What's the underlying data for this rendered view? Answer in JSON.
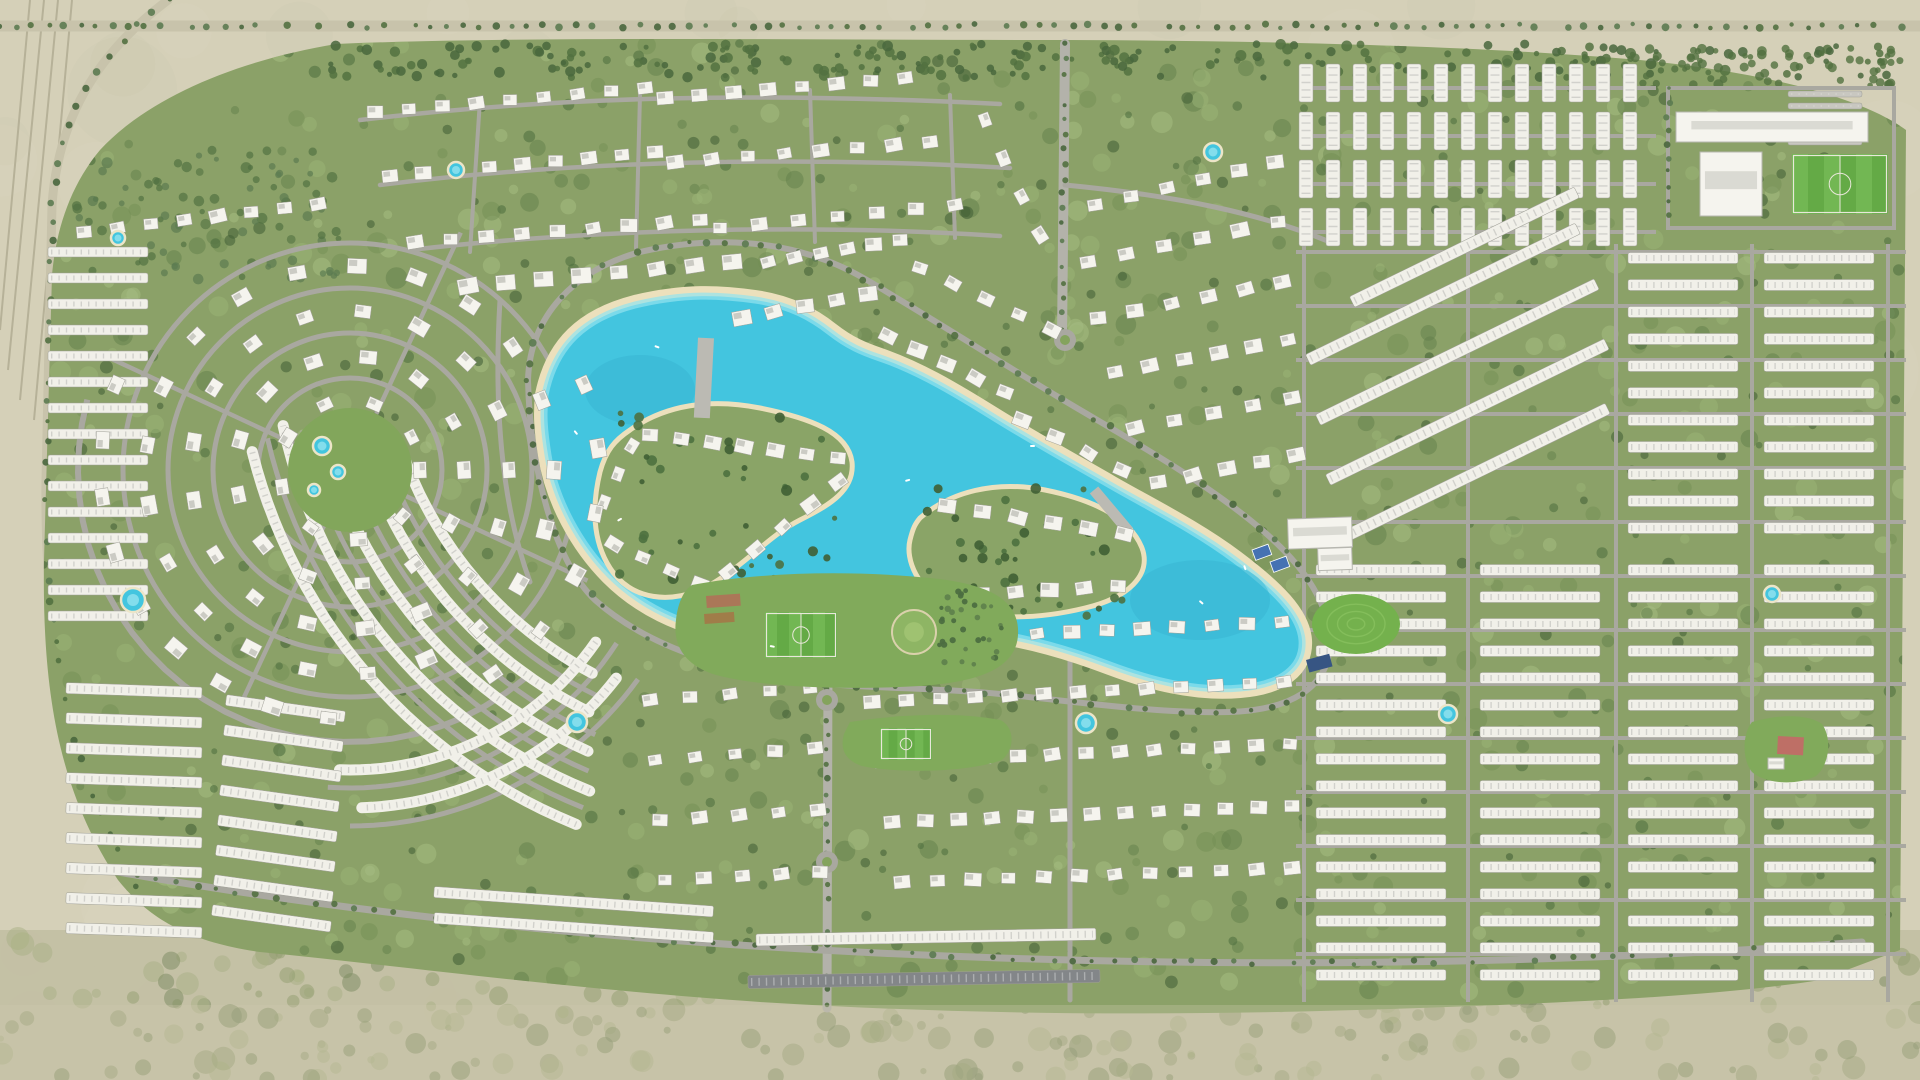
{
  "meta": {
    "type": "community-master-plan-aerial-render",
    "colors": {
      "desert": "#d4cfb6",
      "scrub": "#c0bda0",
      "green_base": "#879e62",
      "road": "#a6a59d",
      "boulevard": "#b0afa7",
      "building_white": "#f5f4ee",
      "building_dark_roof": "#7e8285",
      "water": "#3cc3de",
      "water_shallow": "#8fe2ef",
      "beach_sand": "#ecdfba",
      "pitch_green": "#5ea73f",
      "court_blue": "#3e6db0",
      "park_green": "#7ca755",
      "tree_dark": "#4a6a39"
    }
  },
  "desert": {
    "rails": [
      "M30,0 L0,330",
      "M44,0 L8,370",
      "M58,0 L20,400",
      "M72,0 L34,420"
    ],
    "left_highway": "M168,0 C95,55 58,120 52,205 L46,480 C44,640 70,780 140,890",
    "top_highway": "M0,26 L1920,26",
    "west_spur": "M46,478 L150,474"
  },
  "green_path": "M336,44 C240,60 150,96 100,150 C70,186 56,230 52,275 L44,560 C42,690 58,790 118,880 C150,920 190,942 260,952 C420,968 560,988 760,1002 C980,1016 1200,1016 1420,1008 C1580,1002 1720,996 1820,980 L1900,950 L1906,130 C1860,96 1760,72 1640,60 C1480,46 1260,40 1040,40 C800,40 520,36 336,44 Z",
  "roads": {
    "paths": [
      {
        "d": "M360,120 C560,96 760,92 1000,104",
        "w": 4.5
      },
      {
        "d": "M380,185 C580,160 800,156 1010,168",
        "w": 4.5
      },
      {
        "d": "M410,250 C600,228 820,224 1000,236",
        "w": 4.5
      },
      {
        "d": "M480,100 L470,252",
        "w": 4
      },
      {
        "d": "M640,95 L636,248",
        "w": 4
      },
      {
        "d": "M810,90 L815,242",
        "w": 4
      },
      {
        "d": "M950,95 L955,238",
        "w": 4
      },
      {
        "d": "M1065,44 L1062,340",
        "w": 10,
        "c": "#b0afa7"
      },
      {
        "d": "M1065,185 C1180,196 1262,214 1330,242",
        "w": 5
      },
      {
        "d": "M500,300 C494,400 500,500 530,582",
        "w": 5
      },
      {
        "d": "M828,660 L827,1008",
        "w": 9,
        "c": "#b0afa7"
      },
      {
        "d": "M528,380 C530,315 575,270 640,252 C700,238 755,240 800,252 C845,264 870,282 900,300 C950,330 1000,362 1060,398 C1120,434 1190,472 1250,520 C1300,560 1330,600 1330,645 C1328,688 1290,710 1230,712 C1160,714 1080,702 1000,694 C920,686 840,690 770,676 C700,662 640,640 595,600 C555,562 530,470 528,380 Z",
        "w": 6
      },
      {
        "d": "M118,872 C400,922 700,948 1000,958 C1300,968 1600,962 1862,942",
        "w": 7
      },
      {
        "d": "M1070,620 L1070,1000",
        "w": 5
      },
      {
        "d": "M1668,88 L1894,88 L1894,228 L1668,228 Z",
        "w": 4
      }
    ],
    "hlines": [
      {
        "x1": 1296,
        "x2": 1906,
        "ys": [
          252,
          306,
          360,
          414,
          468,
          522,
          576,
          630,
          684,
          738,
          792,
          846,
          900,
          954
        ],
        "w": 4
      },
      {
        "x1": 1300,
        "x2": 1656,
        "ys": [
          88,
          136,
          184,
          232
        ],
        "w": 4
      }
    ],
    "vlines": [
      {
        "y1": 244,
        "y2": 1002,
        "xs": [
          1304,
          1468,
          1616,
          1752,
          1888
        ],
        "w": 4
      }
    ],
    "rings": [
      [
        350,
        470,
        92,
        5
      ],
      [
        350,
        470,
        137,
        5
      ],
      [
        350,
        470,
        182,
        5
      ],
      [
        350,
        470,
        227,
        5
      ]
    ],
    "arcs": [
      [
        780,
        320,
        418,
        116,
        164,
        5
      ],
      [
        780,
        320,
        454,
        114,
        166,
        5
      ],
      [
        780,
        320,
        490,
        113,
        167,
        5
      ],
      [
        780,
        320,
        526,
        112,
        167,
        5
      ],
      [
        350,
        470,
        318,
        33,
        94,
        5
      ],
      [
        350,
        470,
        356,
        36,
        90,
        5
      ],
      [
        350,
        470,
        272,
        50,
        195,
        6
      ]
    ],
    "spokes": {
      "cx": 350,
      "cy": 470,
      "r0": 62,
      "r1": 262,
      "angles": [
        25,
        115,
        205,
        295
      ],
      "w": 4.5
    },
    "roundabouts": [
      [
        1065,
        340
      ],
      [
        827,
        700
      ],
      [
        827,
        862
      ]
    ]
  },
  "treelines": [
    {
      "d": "M0,26 L1920,26",
      "step": 16,
      "r": 3
    },
    {
      "d": "M1065,44 L1062,340",
      "step": 15,
      "r": 2.8
    },
    {
      "d": "M828,660 L827,1008",
      "step": 15,
      "r": 2.8
    },
    {
      "d": "M528,380 C530,315 575,270 640,252 C700,238 755,240 800,252 C845,264 870,282 900,300 C950,330 1000,362 1060,398 C1120,434 1190,472 1250,520 C1300,560 1330,600 1330,645 C1328,688 1290,710 1230,712 C1160,714 1080,702 1000,694 C920,686 840,690 770,676 C700,662 640,640 595,600 C555,562 530,470 528,380 Z",
      "step": 18,
      "r": 3
    },
    {
      "d": "M168,0 C95,55 58,120 52,205 L46,480 C44,640 70,780 140,890",
      "step": 20,
      "r": 3
    },
    {
      "d": "M118,872 C400,922 700,948 1000,958 C1300,968 1600,962 1862,942",
      "step": 20,
      "r": 2.8
    },
    {
      "d": "M1668,88 L1668,228",
      "step": 14,
      "r": 2.6
    }
  ],
  "scatters": [
    {
      "name": "desert-shading",
      "x": 0,
      "y": 0,
      "w": 1920,
      "h": 1080,
      "n": 130,
      "r0": 18,
      "r1": 55,
      "colors": [
        "#dcd7c0",
        "#c9c4a9"
      ],
      "op": 0.22,
      "seed": 11
    },
    {
      "name": "scrub-band",
      "x": 0,
      "y": 935,
      "w": 1920,
      "h": 145,
      "n": 320,
      "r0": 3,
      "r1": 12,
      "colors": [
        "#8e9a6a",
        "#76855a",
        "#a5ad7f"
      ],
      "op": 0.5,
      "seed": 7
    },
    {
      "name": "green-mottle",
      "x": 42,
      "y": 42,
      "w": 1862,
      "h": 950,
      "n": 760,
      "r0": 4,
      "r1": 11,
      "colors": [
        "#6e8a4d",
        "#97b171",
        "#5c7944",
        "#a3bb7e"
      ],
      "op": 0.5,
      "seed": 3,
      "clip": 1
    },
    {
      "name": "tree-clumps",
      "x": 42,
      "y": 42,
      "w": 1862,
      "h": 950,
      "n": 400,
      "r0": 3,
      "r1": 6.5,
      "colors": [
        "#4a6a39",
        "#3e5c30"
      ],
      "op": 0.6,
      "seed": 9,
      "clip": 1
    },
    {
      "name": "top-tree-band",
      "x": 330,
      "y": 44,
      "w": 1560,
      "h": 34,
      "n": 230,
      "r0": 2.5,
      "r1": 5.5,
      "colors": [
        "#4c6c3a",
        "#426236"
      ],
      "op": 0.85,
      "seed": 5
    },
    {
      "name": "nw-tree-band",
      "x": 70,
      "y": 150,
      "w": 270,
      "h": 130,
      "n": 90,
      "r0": 2.5,
      "r1": 5.5,
      "colors": [
        "#4c6c3a",
        "#55764a"
      ],
      "op": 0.7,
      "seed": 6,
      "clip": 1
    },
    {
      "name": "school-tree-band",
      "x": 1600,
      "y": 48,
      "w": 300,
      "h": 38,
      "n": 70,
      "r0": 2.5,
      "r1": 5,
      "colors": [
        "#4c6c3a"
      ],
      "op": 0.8,
      "seed": 16
    }
  ],
  "lagoon": {
    "water_d": "M545,395 C555,345 585,318 635,305 C685,293 720,295 755,300 C790,305 812,318 830,332 C848,346 862,352 880,358 C915,370 950,390 990,415 C1030,440 1070,462 1110,485 C1150,508 1195,530 1235,560 C1275,590 1300,615 1302,640 C1304,668 1280,685 1240,688 C1195,692 1150,680 1110,665 C1070,650 1030,638 985,632 C940,626 895,625 850,628 C805,631 765,638 725,632 C680,625 640,605 610,575 C580,545 555,500 548,455 C544,430 543,415 545,395 Z",
    "deep_spots": [
      [
        640,
        390,
        55,
        35
      ],
      [
        1200,
        600,
        70,
        40
      ]
    ],
    "islands": [
      {
        "name": "island-west",
        "d": "M630,430 C665,405 710,398 760,408 C810,418 848,432 852,462 C855,490 830,505 800,520 C770,535 745,565 710,585 C672,606 630,600 610,568 C592,540 592,505 600,472 C606,450 615,440 630,430 Z"
      },
      {
        "name": "island-east",
        "d": "M920,518 C950,492 995,480 1045,490 C1095,500 1130,518 1142,548 C1152,575 1128,598 1085,608 C1040,619 985,622 948,604 C918,590 905,560 910,540 C913,528 915,524 920,518 Z"
      }
    ],
    "island_tree_scatters": [
      {
        "x": 612,
        "y": 412,
        "w": 232,
        "h": 185,
        "n": 46,
        "r0": 2.5,
        "r1": 5.5,
        "colors": [
          "#466c38",
          "#39592c"
        ],
        "op": 0.9,
        "seed": 13
      },
      {
        "x": 918,
        "y": 488,
        "w": 218,
        "h": 128,
        "n": 36,
        "r0": 2.5,
        "r1": 5.5,
        "colors": [
          "#466c38",
          "#39592c"
        ],
        "op": 0.9,
        "seed": 14
      }
    ],
    "bridges": [
      [
        706,
        338,
        16,
        80,
        3
      ],
      [
        1094,
        490,
        11,
        54,
        -40
      ],
      [
        698,
        580,
        10,
        56,
        1
      ]
    ],
    "boats": [
      [
        655,
        345,
        20
      ],
      [
        905,
        480,
        -15
      ],
      [
        1200,
        600,
        40
      ],
      [
        770,
        645,
        10
      ],
      [
        617,
        520,
        -30
      ],
      [
        1245,
        565,
        70
      ],
      [
        1030,
        445,
        0
      ],
      [
        575,
        430,
        50
      ]
    ]
  },
  "villa_rows": [
    [
      375,
      112,
      645,
      88,
      9,
      15
    ],
    [
      665,
      98,
      905,
      78,
      8,
      15
    ],
    [
      390,
      176,
      655,
      152,
      9,
      15
    ],
    [
      675,
      162,
      930,
      142,
      8,
      15
    ],
    [
      415,
      242,
      700,
      220,
      9,
      15
    ],
    [
      720,
      228,
      955,
      205,
      7,
      15
    ],
    [
      985,
      120,
      1040,
      235,
      4,
      15
    ],
    [
      468,
      286,
      732,
      262,
      8,
      19
    ],
    [
      742,
      318,
      868,
      294,
      5,
      17
    ],
    [
      888,
      336,
      1005,
      392,
      5,
      17
    ],
    [
      1022,
      420,
      1122,
      470,
      4,
      17
    ],
    [
      768,
      262,
      900,
      240,
      6,
      15
    ],
    [
      920,
      268,
      1052,
      330,
      5,
      15
    ],
    [
      1095,
      205,
      1275,
      162,
      6,
      16
    ],
    [
      1088,
      262,
      1278,
      222,
      6,
      16
    ],
    [
      1098,
      318,
      1282,
      282,
      6,
      16
    ],
    [
      1115,
      372,
      1288,
      340,
      6,
      16
    ],
    [
      1135,
      428,
      1292,
      398,
      5,
      16
    ],
    [
      1158,
      482,
      1296,
      455,
      5,
      16
    ],
    [
      84,
      232,
      318,
      204,
      8,
      15
    ],
    [
      650,
      435,
      838,
      458,
      7,
      16
    ],
    [
      838,
      482,
      728,
      572,
      5,
      16
    ],
    [
      700,
      584,
      614,
      544,
      4,
      15
    ],
    [
      604,
      502,
      632,
      446,
      3,
      14
    ],
    [
      947,
      506,
      1124,
      534,
      6,
      16
    ],
    [
      947,
      596,
      1118,
      586,
      6,
      16
    ],
    [
      862,
      642,
      1282,
      622,
      13,
      15
    ],
    [
      872,
      702,
      1284,
      682,
      13,
      15
    ],
    [
      882,
      762,
      1290,
      744,
      13,
      15
    ],
    [
      892,
      822,
      1292,
      806,
      13,
      15
    ],
    [
      902,
      882,
      1292,
      868,
      12,
      15
    ],
    [
      650,
      700,
      810,
      688,
      5,
      14
    ],
    [
      655,
      760,
      815,
      748,
      5,
      14
    ],
    [
      660,
      820,
      818,
      810,
      5,
      14
    ],
    [
      665,
      880,
      820,
      872,
      5,
      14
    ]
  ],
  "villa_rings": [
    [
      350,
      470,
      70,
      0,
      332,
      9,
      15
    ],
    [
      350,
      470,
      114,
      0,
      335,
      13,
      16
    ],
    [
      350,
      470,
      159,
      0,
      338,
      17,
      17
    ],
    [
      350,
      470,
      204,
      0,
      340,
      21,
      17
    ],
    [
      350,
      470,
      249,
      95,
      200,
      9,
      17
    ],
    [
      350,
      470,
      249,
      -20,
      55,
      6,
      17
    ]
  ],
  "spiral_core": {
    "cx": 350,
    "cy": 470,
    "r": 62,
    "fill": "#7da355"
  },
  "arc_rows": [
    [
      780,
      320,
      400,
      118,
      162,
      11
    ],
    [
      780,
      320,
      436,
      116,
      164,
      11
    ],
    [
      780,
      320,
      472,
      114,
      166,
      11
    ],
    [
      780,
      320,
      508,
      112,
      168,
      11
    ],
    [
      780,
      320,
      544,
      112,
      166,
      11
    ],
    [
      350,
      470,
      300,
      35,
      92,
      11
    ],
    [
      350,
      470,
      338,
      38,
      88,
      11
    ]
  ],
  "bar_groups": [
    {
      "x": 1306,
      "y": 64,
      "ang": 90,
      "n": 13,
      "dx": 27,
      "dy": 0,
      "len": 38,
      "bw": 14
    },
    {
      "x": 1306,
      "y": 112,
      "ang": 90,
      "n": 13,
      "dx": 27,
      "dy": 0,
      "len": 38,
      "bw": 14
    },
    {
      "x": 1306,
      "y": 160,
      "ang": 90,
      "n": 13,
      "dx": 27,
      "dy": 0,
      "len": 38,
      "bw": 14
    },
    {
      "x": 1306,
      "y": 208,
      "ang": 90,
      "n": 13,
      "dx": 27,
      "dy": 0,
      "len": 38,
      "bw": 14
    },
    {
      "x": 1628,
      "y": 258,
      "ang": 0,
      "n": 11,
      "dx": 0,
      "dy": 27,
      "len": 110,
      "bw": 11
    },
    {
      "x": 1764,
      "y": 258,
      "ang": 0,
      "n": 11,
      "dx": 0,
      "dy": 27,
      "len": 110,
      "bw": 11
    },
    {
      "x": 1316,
      "y": 570,
      "ang": 0,
      "n": 16,
      "dx": 0,
      "dy": 27,
      "len": 130,
      "bw": 11
    },
    {
      "x": 1480,
      "y": 570,
      "ang": 0,
      "n": 16,
      "dx": 0,
      "dy": 27,
      "len": 120,
      "bw": 11
    },
    {
      "x": 1628,
      "y": 570,
      "ang": 0,
      "n": 16,
      "dx": 0,
      "dy": 27,
      "len": 110,
      "bw": 11
    },
    {
      "x": 1764,
      "y": 570,
      "ang": 0,
      "n": 16,
      "dx": 0,
      "dy": 27,
      "len": 110,
      "bw": 11
    },
    {
      "x": 1308,
      "y": 360,
      "ang": -26,
      "n": 1,
      "dx": 0,
      "dy": 0,
      "len": 300,
      "bw": 12
    },
    {
      "x": 1318,
      "y": 420,
      "ang": -26,
      "n": 1,
      "dx": 0,
      "dy": 0,
      "len": 310,
      "bw": 12
    },
    {
      "x": 1328,
      "y": 480,
      "ang": -26,
      "n": 1,
      "dx": 0,
      "dy": 0,
      "len": 310,
      "bw": 12
    },
    {
      "x": 1338,
      "y": 540,
      "ang": -26,
      "n": 1,
      "dx": 0,
      "dy": 0,
      "len": 300,
      "bw": 12
    },
    {
      "x": 1352,
      "y": 302,
      "ang": -26,
      "n": 1,
      "dx": 0,
      "dy": 0,
      "len": 250,
      "bw": 12
    },
    {
      "x": 1788,
      "y": 94,
      "ang": 0,
      "n": 5,
      "dx": 0,
      "dy": 12,
      "len": 74,
      "bw": 6,
      "fill": "#c6c5be"
    },
    {
      "x": 66,
      "y": 688,
      "ang": 2,
      "n": 9,
      "dx": 0,
      "dy": 30,
      "len": 136,
      "bw": 11
    },
    {
      "x": 226,
      "y": 700,
      "ang": 8,
      "n": 8,
      "dx": -2,
      "dy": 30,
      "len": 120,
      "bw": 11
    },
    {
      "x": 48,
      "y": 252,
      "ang": 0,
      "n": 15,
      "dx": 0,
      "dy": 26,
      "len": 100,
      "bw": 10
    },
    {
      "x": 434,
      "y": 892,
      "ang": 4,
      "n": 2,
      "dx": 0,
      "dy": 26,
      "len": 280,
      "bw": 11
    },
    {
      "x": 756,
      "y": 940,
      "ang": -1,
      "n": 1,
      "dx": 0,
      "dy": 0,
      "len": 340,
      "bw": 12
    },
    {
      "x": 748,
      "y": 982,
      "ang": -1,
      "n": 1,
      "dx": 0,
      "dy": 0,
      "len": 352,
      "bw": 13,
      "fill": "#7e8285"
    }
  ],
  "amenities": {
    "blobs": [
      {
        "name": "central-park",
        "d": "M692,585 C760,572 850,570 930,578 C990,584 1020,600 1018,635 C1016,668 980,682 920,686 C850,690 770,688 720,676 C688,668 672,648 676,620 C678,602 684,590 692,585 Z",
        "fill": "#7ca755"
      },
      {
        "name": "south-park",
        "d": "M850,722 C900,714 960,712 1000,720 C1014,726 1016,748 1002,760 C970,772 900,774 862,766 C844,760 840,748 844,734 Z",
        "fill": "#7ca755"
      },
      {
        "name": "se-park",
        "d": "M1752,722 C1780,714 1808,714 1822,724 C1832,738 1830,764 1816,776 C1796,786 1766,784 1752,772 C1742,760 1742,734 1752,722 Z",
        "fill": "#7ca755"
      }
    ],
    "pitches": [
      [
        765,
        612,
        72,
        46
      ],
      [
        880,
        728,
        52,
        32
      ],
      [
        1792,
        154,
        96,
        60
      ]
    ],
    "big_buildings": [
      [
        1676,
        112,
        192,
        30,
        0
      ],
      [
        1700,
        152,
        62,
        64,
        0
      ],
      [
        1288,
        518,
        64,
        30,
        -2
      ],
      [
        1318,
        548,
        34,
        22,
        -2
      ],
      [
        1768,
        758,
        16,
        11,
        0
      ]
    ],
    "courts": [
      [
        1252,
        550
      ],
      [
        1270,
        562
      ]
    ],
    "solar": [
      [
        1306,
        660,
        24,
        13,
        -15
      ]
    ],
    "hill": {
      "cx": 1356,
      "cy": 624,
      "rx": 44,
      "ry": 30,
      "fill": "#6fae46",
      "ring": "#7fbc55"
    },
    "garden": {
      "cx": 914,
      "cy": 632,
      "r": 22,
      "fill": "#8ab25e",
      "inner": "#9cc06c",
      "edge": "#d9d0a9"
    },
    "beds": [
      [
        706,
        596,
        34,
        12,
        -4,
        "#b06852"
      ],
      [
        704,
        614,
        30,
        10,
        -4,
        "#a3703f"
      ],
      [
        1778,
        736,
        26,
        18,
        3,
        "#c85f63"
      ]
    ],
    "orchard": {
      "x": 938,
      "y": 590,
      "w": 66,
      "h": 76,
      "n": 34,
      "r0": 2,
      "r1": 3.2,
      "colors": [
        "#46683a",
        "#5a7c46"
      ],
      "op": 0.95,
      "seed": 15
    }
  },
  "pools": [
    [
      118,
      238,
      7
    ],
    [
      133,
      600,
      12
    ],
    [
      456,
      170,
      8
    ],
    [
      577,
      722,
      10
    ],
    [
      1086,
      723,
      10
    ],
    [
      1213,
      152,
      9
    ],
    [
      1448,
      714,
      9
    ],
    [
      1772,
      594,
      8
    ],
    [
      322,
      446,
      9
    ],
    [
      338,
      472,
      7
    ],
    [
      314,
      490,
      6
    ]
  ],
  "haze": {
    "bottom_fill": "#cdc8ac",
    "bottom_op": 0.32,
    "global_fill": "#ffffff",
    "global_op": 0.04
  }
}
